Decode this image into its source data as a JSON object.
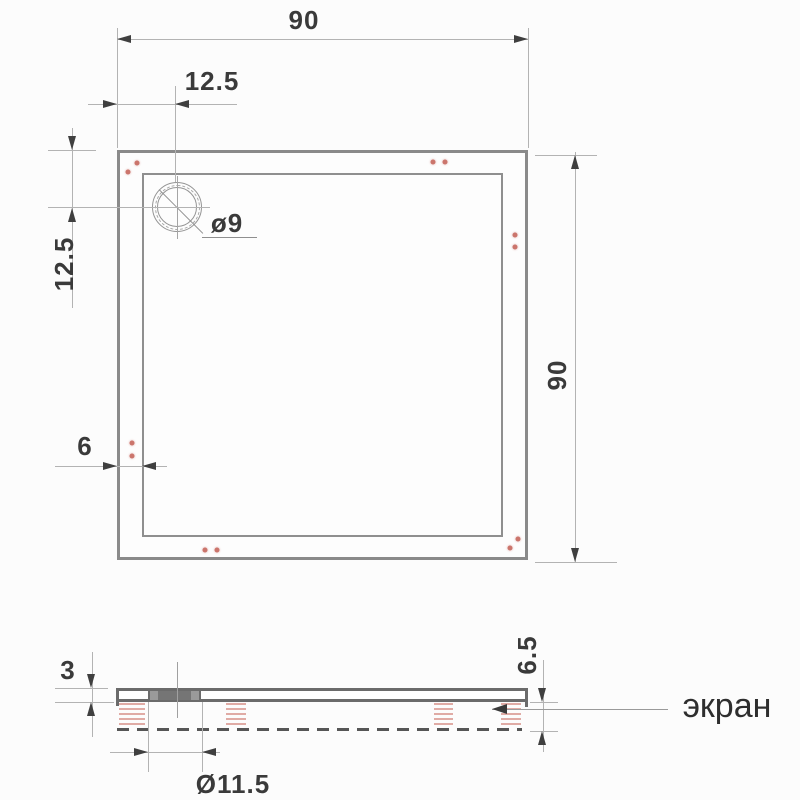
{
  "drawing": {
    "title_hint": "shower tray technical drawing",
    "top_view": {
      "width_label": "90",
      "height_label": "90",
      "drain_offset_x_label": "12.5",
      "drain_offset_y_label": "12.5",
      "rim_thickness_label": "6",
      "drain_diameter_label": "ø9"
    },
    "side_view": {
      "tray_thickness_label": "3",
      "total_height_label": "6.5",
      "drain_boss_diameter_label": "Ø11.5",
      "screen_label": "экран"
    },
    "colors": {
      "outline_gray": "#8a8a8a",
      "dim_line_gray": "#b3b3b3",
      "text_dark": "#3a3a3a",
      "watermark_red": "#bf5449",
      "side_profile_gray": "#6b6b6b"
    }
  }
}
